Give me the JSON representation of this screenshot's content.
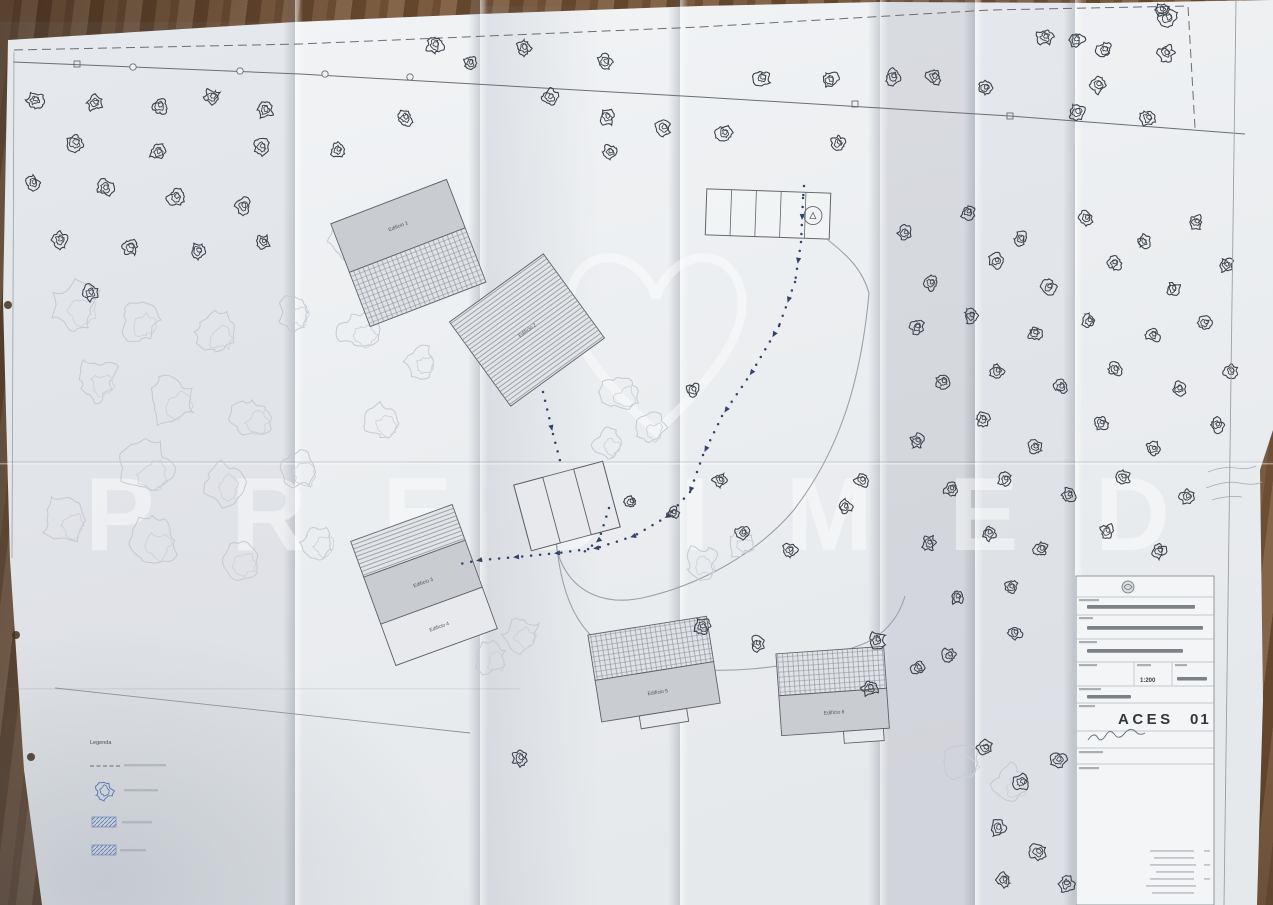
{
  "photo": {
    "subject": "folded architectural site plan on wooden table",
    "paper_color": "#eef0f2",
    "wood_color": "#74553c"
  },
  "watermark": {
    "text": "PREDIMED",
    "logo": "heart",
    "color": "#ffffff"
  },
  "title_block": {
    "drawing_code": "ACES",
    "drawing_number": "01",
    "scale": "1:200",
    "field_rows": 6,
    "has_signature": true,
    "has_logo": true
  },
  "legend": {
    "title": "Legenda",
    "items": [
      {
        "symbol": "dashed-line"
      },
      {
        "symbol": "blue-tree"
      },
      {
        "symbol": "blue-hatch"
      },
      {
        "symbol": "blue-hatch"
      }
    ]
  },
  "buildings": [
    {
      "x": 408,
      "y": 252,
      "rot": -21,
      "parts": [
        {
          "x": -62,
          "y": -54,
          "w": 124,
          "h": 52,
          "f": "grey",
          "label": "Edifício 1"
        },
        {
          "x": -62,
          "y": -2,
          "w": 124,
          "h": 58,
          "f": "grid"
        }
      ]
    },
    {
      "x": 527,
      "y": 330,
      "rot": -36,
      "parts": [
        {
          "x": -58,
          "y": -52,
          "w": 116,
          "h": 104,
          "f": "lines",
          "label": "Edifício 2"
        }
      ]
    },
    {
      "x": 567,
      "y": 506,
      "rot": -15,
      "parts": [
        {
          "x": -46,
          "y": -34,
          "w": 92,
          "h": 68,
          "f": "light"
        },
        {
          "x": -46,
          "y": -34,
          "w": 30,
          "h": 68,
          "f": "none"
        },
        {
          "x": 16,
          "y": -34,
          "w": 30,
          "h": 68,
          "f": "none"
        }
      ]
    },
    {
      "x": 424,
      "y": 585,
      "rot": -20,
      "parts": [
        {
          "x": -54,
          "y": -66,
          "w": 108,
          "h": 38,
          "f": "lines"
        },
        {
          "x": -54,
          "y": -28,
          "w": 108,
          "h": 50,
          "f": "grey",
          "label": "Edifício 3"
        },
        {
          "x": -54,
          "y": 22,
          "w": 108,
          "h": 44,
          "f": "light",
          "label": "Edifício 4"
        }
      ]
    },
    {
      "x": 655,
      "y": 675,
      "rot": -9,
      "parts": [
        {
          "x": -60,
          "y": -50,
          "w": 120,
          "h": 46,
          "f": "grid"
        },
        {
          "x": -60,
          "y": -4,
          "w": 120,
          "h": 42,
          "f": "grey",
          "label": "Edifício 5"
        },
        {
          "x": -22,
          "y": 38,
          "w": 48,
          "h": 13,
          "f": "light"
        }
      ]
    },
    {
      "x": 833,
      "y": 696,
      "rot": -4,
      "parts": [
        {
          "x": -54,
          "y": -46,
          "w": 108,
          "h": 42,
          "f": "grid"
        },
        {
          "x": -54,
          "y": -4,
          "w": 108,
          "h": 40,
          "f": "grey",
          "label": "Edifício 6"
        },
        {
          "x": 8,
          "y": 36,
          "w": 40,
          "h": 12,
          "f": "light"
        }
      ]
    }
  ],
  "parking": {
    "x": 768,
    "y": 214,
    "rot": 2,
    "w": 124,
    "h": 46,
    "stalls": 5,
    "circle": [
      45,
      0,
      9
    ]
  },
  "walkways": [
    [
      [
        804,
        186
      ],
      [
        803,
        198
      ],
      [
        801,
        242
      ],
      [
        795,
        282
      ],
      [
        779,
        326
      ],
      [
        752,
        372
      ],
      [
        722,
        416
      ],
      [
        703,
        455
      ],
      [
        690,
        492
      ],
      [
        668,
        516
      ],
      [
        634,
        536
      ],
      [
        597,
        548
      ],
      [
        558,
        553
      ],
      [
        517,
        557
      ],
      [
        480,
        560
      ],
      [
        455,
        565
      ]
    ],
    [
      [
        543,
        392
      ],
      [
        553,
        434
      ],
      [
        562,
        468
      ]
    ],
    [
      [
        609,
        508
      ],
      [
        599,
        540
      ],
      [
        584,
        552
      ]
    ]
  ],
  "paths": {
    "boundary": [
      [
        14,
        50
      ],
      [
        300,
        44
      ],
      [
        700,
        27
      ],
      [
        990,
        10
      ],
      [
        1188,
        6
      ],
      [
        1195,
        128
      ]
    ],
    "fence": [
      [
        13,
        62
      ],
      [
        300,
        74
      ],
      [
        700,
        97
      ],
      [
        1010,
        116
      ],
      [
        1245,
        134
      ]
    ],
    "fence_posts": [
      [
        133,
        67
      ],
      [
        240,
        71
      ],
      [
        325,
        74
      ],
      [
        410,
        77
      ]
    ],
    "fence_gates": [
      [
        77,
        64
      ],
      [
        855,
        104
      ],
      [
        1010,
        116
      ]
    ],
    "roads": [
      "M 869 293 C 861 382 839 452 793 511 C 757 553 701 585 642 598 C 603 606 576 591 563 566 C 557 554 556 546 556 538",
      "M 556 538 C 561 600 580 648 641 662 C 712 678 791 670 858 646 C 884 637 899 617 905 596",
      "M 828 240 C 851 258 863 272 869 293"
    ],
    "ground_line": [
      [
        55,
        688
      ],
      [
        470,
        733
      ]
    ]
  },
  "trees": [
    [
      35,
      100,
      8
    ],
    [
      95,
      103,
      8
    ],
    [
      160,
      106,
      8
    ],
    [
      212,
      97,
      8
    ],
    [
      265,
      110,
      8
    ],
    [
      75,
      143,
      9
    ],
    [
      158,
      152,
      8
    ],
    [
      262,
      147,
      8
    ],
    [
      33,
      183,
      7
    ],
    [
      105,
      188,
      8
    ],
    [
      176,
      197,
      8
    ],
    [
      243,
      206,
      8
    ],
    [
      60,
      240,
      8
    ],
    [
      130,
      247,
      8
    ],
    [
      198,
      251,
      8
    ],
    [
      263,
      242,
      7
    ],
    [
      90,
      293,
      8
    ],
    [
      338,
      150,
      7
    ],
    [
      405,
      118,
      8
    ],
    [
      435,
      45,
      9
    ],
    [
      470,
      63,
      7
    ],
    [
      524,
      48,
      8
    ],
    [
      605,
      62,
      8
    ],
    [
      550,
      97,
      8
    ],
    [
      607,
      117,
      8
    ],
    [
      663,
      128,
      8
    ],
    [
      724,
      133,
      8
    ],
    [
      610,
      152,
      7
    ],
    [
      762,
      78,
      8
    ],
    [
      830,
      80,
      8
    ],
    [
      893,
      77,
      8
    ],
    [
      934,
      77,
      8
    ],
    [
      985,
      88,
      7
    ],
    [
      838,
      143,
      7
    ],
    [
      1045,
      37,
      8
    ],
    [
      1076,
      40,
      8
    ],
    [
      1104,
      50,
      8
    ],
    [
      1168,
      18,
      9
    ],
    [
      1166,
      53,
      8
    ],
    [
      1098,
      85,
      8
    ],
    [
      1077,
      112,
      8
    ],
    [
      1148,
      118,
      8
    ],
    [
      1161,
      10,
      7
    ],
    [
      905,
      233,
      7
    ],
    [
      968,
      212,
      7
    ],
    [
      1021,
      239,
      7
    ],
    [
      1086,
      218,
      7
    ],
    [
      1143,
      242,
      7
    ],
    [
      1196,
      222,
      7
    ],
    [
      931,
      283,
      7
    ],
    [
      996,
      261,
      7
    ],
    [
      1049,
      287,
      7
    ],
    [
      1114,
      263,
      7
    ],
    [
      1173,
      289,
      7
    ],
    [
      1226,
      265,
      7
    ],
    [
      917,
      327,
      7
    ],
    [
      971,
      316,
      7
    ],
    [
      1035,
      333,
      7
    ],
    [
      1089,
      321,
      7
    ],
    [
      1153,
      335,
      7
    ],
    [
      1205,
      323,
      7
    ],
    [
      943,
      382,
      7
    ],
    [
      997,
      371,
      7
    ],
    [
      1061,
      387,
      7
    ],
    [
      1115,
      369,
      7
    ],
    [
      1179,
      389,
      7
    ],
    [
      1231,
      371,
      7
    ],
    [
      917,
      441,
      7
    ],
    [
      983,
      419,
      7
    ],
    [
      1035,
      447,
      7
    ],
    [
      1101,
      423,
      7
    ],
    [
      1153,
      449,
      7
    ],
    [
      1217,
      425,
      7
    ],
    [
      951,
      489,
      7
    ],
    [
      1005,
      479,
      7
    ],
    [
      1069,
      495,
      7
    ],
    [
      1123,
      477,
      7
    ],
    [
      1187,
      497,
      7
    ],
    [
      929,
      543,
      7
    ],
    [
      989,
      533,
      7
    ],
    [
      1041,
      549,
      7
    ],
    [
      1107,
      531,
      7
    ],
    [
      1159,
      551,
      7
    ],
    [
      957,
      597,
      7
    ],
    [
      1011,
      587,
      7
    ],
    [
      949,
      655,
      7
    ],
    [
      1015,
      633,
      7
    ],
    [
      918,
      668,
      7
    ],
    [
      693,
      390,
      7
    ],
    [
      720,
      480,
      7
    ],
    [
      743,
      533,
      7
    ],
    [
      790,
      550,
      7
    ],
    [
      845,
      507,
      7
    ],
    [
      862,
      480,
      7
    ],
    [
      631,
      502,
      6
    ],
    [
      673,
      513,
      6
    ],
    [
      520,
      758,
      8
    ],
    [
      702,
      627,
      8
    ],
    [
      757,
      644,
      7
    ],
    [
      877,
      640,
      8
    ],
    [
      870,
      688,
      8
    ],
    [
      985,
      748,
      8
    ],
    [
      1022,
      782,
      8
    ],
    [
      1058,
      760,
      8
    ],
    [
      998,
      828,
      8
    ],
    [
      1038,
      852,
      8
    ],
    [
      1066,
      884,
      8
    ],
    [
      1004,
      880,
      7
    ]
  ],
  "clouds": [
    [
      75,
      305,
      24
    ],
    [
      140,
      320,
      20
    ],
    [
      215,
      332,
      22
    ],
    [
      295,
      312,
      18
    ],
    [
      360,
      330,
      20
    ],
    [
      95,
      380,
      22
    ],
    [
      172,
      400,
      24
    ],
    [
      252,
      418,
      20
    ],
    [
      145,
      468,
      26
    ],
    [
      222,
      482,
      22
    ],
    [
      300,
      470,
      20
    ],
    [
      380,
      422,
      18
    ],
    [
      65,
      520,
      22
    ],
    [
      152,
      540,
      24
    ],
    [
      238,
      560,
      20
    ],
    [
      318,
      542,
      18
    ],
    [
      470,
      612,
      20
    ],
    [
      520,
      634,
      18
    ],
    [
      492,
      658,
      16
    ],
    [
      620,
      392,
      18
    ],
    [
      650,
      428,
      16
    ],
    [
      608,
      444,
      14
    ],
    [
      700,
      562,
      16
    ],
    [
      740,
      542,
      14
    ],
    [
      962,
      762,
      20
    ],
    [
      1010,
      784,
      18
    ],
    [
      1115,
      800,
      16
    ],
    [
      1150,
      842,
      16
    ],
    [
      390,
      300,
      16
    ],
    [
      420,
      362,
      16
    ],
    [
      345,
      242,
      16
    ]
  ],
  "punch_holes": [
    [
      8,
      305
    ],
    [
      16,
      635
    ],
    [
      31,
      757
    ]
  ]
}
